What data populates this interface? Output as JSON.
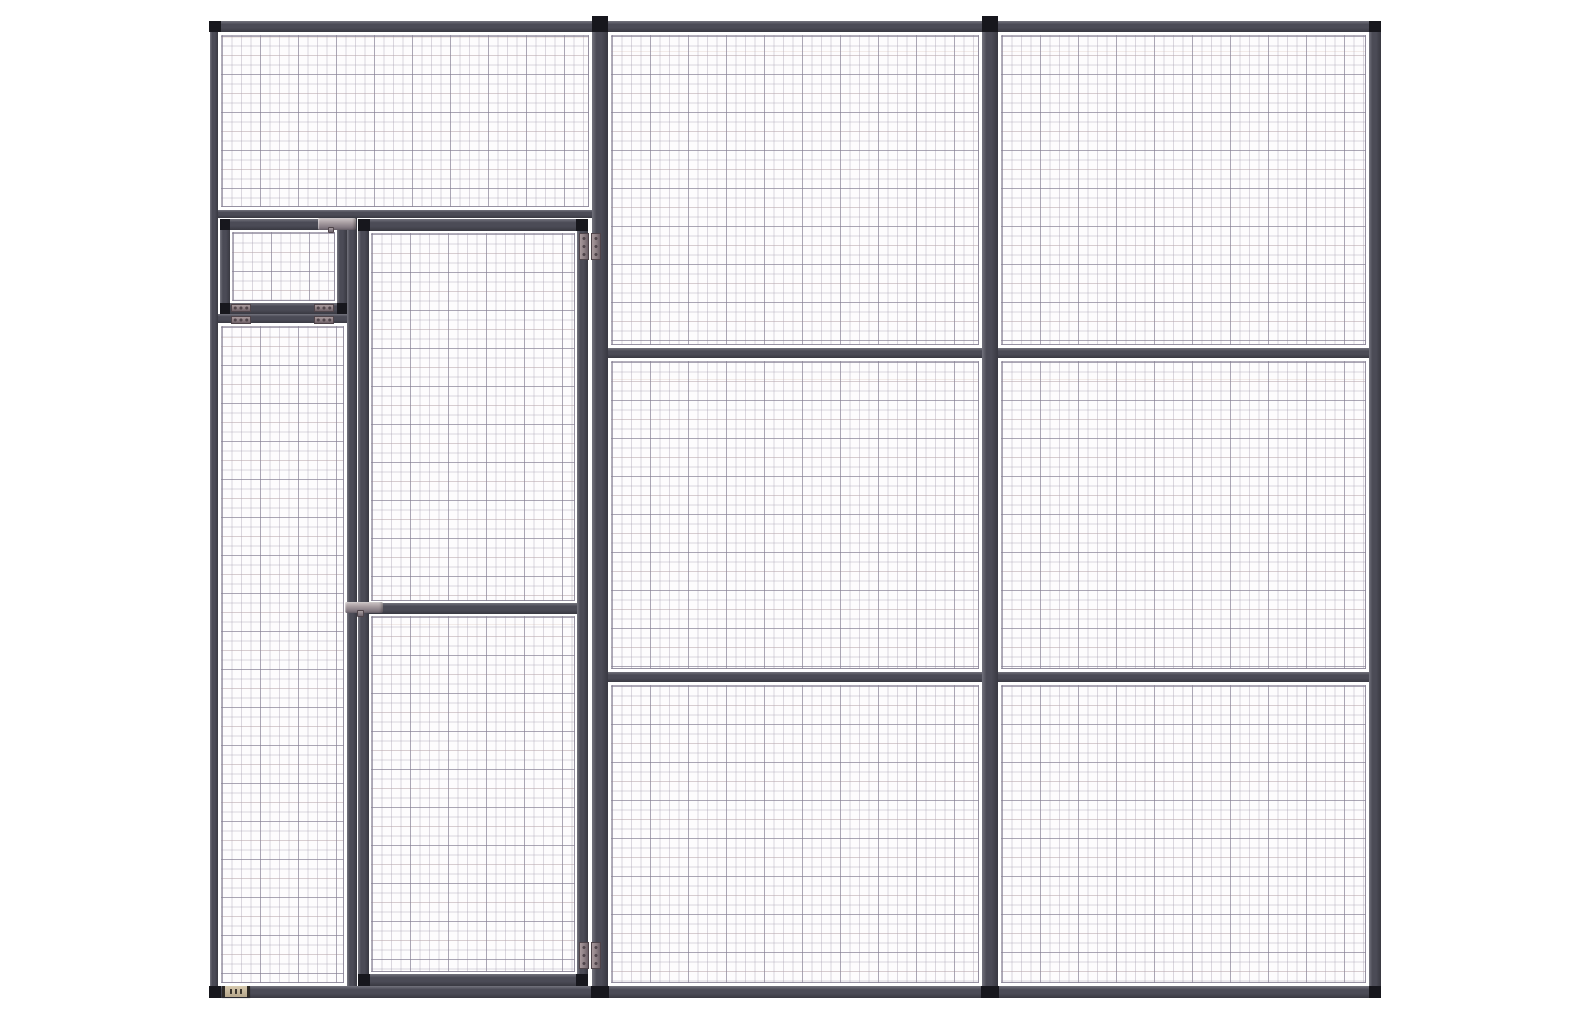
{
  "colors": {
    "background": "#ffffff",
    "panel_bg": "#fdfcfd",
    "frame": "#4b4b56",
    "frame_highlight": "#73737d",
    "frame_shadow": "#393942",
    "connector_block": "#17171d",
    "mesh_line": "rgba(168,162,178,0.42)",
    "mesh_line_major": "rgba(132,125,145,0.55)",
    "mesh_tint": "rgba(206,173,162,0.22)",
    "mesh_border": "rgba(140,133,152,0.65)",
    "hinge": "#8c7e83",
    "hinge_light": "#a99a9d",
    "hinge_dark2": "#6e6168",
    "hinge_dark": "#4f444a",
    "latch": "#a89da1",
    "latch_light": "#cfc7c9",
    "latch_dark": "#6f6670",
    "nameplate": "#b5a68a",
    "nameplate_light": "#d6c9ae",
    "nameplate_dark": "#3b352d",
    "nameplate_cap": "#2e2a26"
  },
  "parts": [
    {
      "kind": "mesh",
      "name": "left-bay-top-mesh-panel",
      "x": 221,
      "y": 35,
      "w": 368,
      "h": 172
    },
    {
      "kind": "mesh",
      "name": "left-column-mesh-panel",
      "x": 221,
      "y": 326,
      "w": 123,
      "h": 657
    },
    {
      "kind": "mesh",
      "name": "hatch-mesh-panel",
      "x": 232,
      "y": 232,
      "w": 103,
      "h": 69
    },
    {
      "kind": "mesh",
      "name": "door-upper-mesh-panel",
      "x": 371,
      "y": 233,
      "w": 204,
      "h": 368
    },
    {
      "kind": "mesh",
      "name": "door-lower-mesh-panel",
      "x": 371,
      "y": 616,
      "w": 204,
      "h": 356
    },
    {
      "kind": "mesh",
      "name": "mid-bay-top-mesh-panel",
      "x": 611,
      "y": 35,
      "w": 368,
      "h": 310
    },
    {
      "kind": "mesh",
      "name": "mid-bay-middle-mesh-panel",
      "x": 611,
      "y": 361,
      "w": 368,
      "h": 308
    },
    {
      "kind": "mesh",
      "name": "mid-bay-bottom-mesh-panel",
      "x": 611,
      "y": 685,
      "w": 368,
      "h": 298
    },
    {
      "kind": "mesh",
      "name": "right-bay-top-mesh-panel",
      "x": 1001,
      "y": 35,
      "w": 365,
      "h": 310
    },
    {
      "kind": "mesh",
      "name": "right-bay-middle-mesh-panel",
      "x": 1001,
      "y": 361,
      "w": 365,
      "h": 308
    },
    {
      "kind": "mesh",
      "name": "right-bay-bottom-mesh-panel",
      "x": 1001,
      "y": 685,
      "w": 365,
      "h": 298
    },
    {
      "kind": "rail",
      "name": "top-rail",
      "x": 210,
      "y": 21,
      "w": 1171,
      "h": 11
    },
    {
      "kind": "rail",
      "name": "bottom-rail",
      "x": 210,
      "y": 986,
      "w": 1171,
      "h": 12
    },
    {
      "kind": "rail",
      "name": "left-bay-transom-rail",
      "x": 218,
      "y": 210,
      "w": 374,
      "h": 8
    },
    {
      "kind": "rail",
      "name": "hatch-sill-rail",
      "x": 218,
      "y": 314,
      "w": 138,
      "h": 9
    },
    {
      "kind": "rail",
      "name": "mid-bay-upper-rail",
      "x": 608,
      "y": 348,
      "w": 374,
      "h": 10
    },
    {
      "kind": "rail",
      "name": "mid-bay-lower-rail",
      "x": 608,
      "y": 672,
      "w": 374,
      "h": 10
    },
    {
      "kind": "rail",
      "name": "right-bay-upper-rail",
      "x": 998,
      "y": 348,
      "w": 371,
      "h": 10
    },
    {
      "kind": "rail",
      "name": "right-bay-lower-rail",
      "x": 998,
      "y": 672,
      "w": 371,
      "h": 10
    },
    {
      "kind": "rail",
      "name": "hatch-top-rail",
      "x": 220,
      "y": 219,
      "w": 127,
      "h": 11
    },
    {
      "kind": "rail",
      "name": "hatch-bottom-rail",
      "x": 220,
      "y": 303,
      "w": 127,
      "h": 11
    },
    {
      "kind": "rail",
      "name": "door-top-rail",
      "x": 358,
      "y": 219,
      "w": 230,
      "h": 12
    },
    {
      "kind": "rail",
      "name": "door-mid-rail",
      "x": 358,
      "y": 603,
      "w": 230,
      "h": 11
    },
    {
      "kind": "rail",
      "name": "door-bottom-rail",
      "x": 358,
      "y": 974,
      "w": 230,
      "h": 12
    },
    {
      "kind": "post",
      "name": "left-upright-post",
      "x": 210,
      "y": 21,
      "w": 8,
      "h": 977
    },
    {
      "kind": "post",
      "name": "door-side-post",
      "x": 592,
      "y": 19,
      "w": 16,
      "h": 979
    },
    {
      "kind": "post",
      "name": "center-post",
      "x": 982,
      "y": 19,
      "w": 16,
      "h": 979
    },
    {
      "kind": "post",
      "name": "right-upright-post",
      "x": 1369,
      "y": 21,
      "w": 12,
      "h": 977
    },
    {
      "kind": "post",
      "name": "left-column-mullion",
      "x": 347,
      "y": 218,
      "w": 10,
      "h": 768
    },
    {
      "kind": "post",
      "name": "hatch-left-stile",
      "x": 220,
      "y": 219,
      "w": 10,
      "h": 95
    },
    {
      "kind": "post",
      "name": "hatch-right-stile",
      "x": 337,
      "y": 219,
      "w": 10,
      "h": 95
    },
    {
      "kind": "post",
      "name": "door-left-stile",
      "x": 358,
      "y": 219,
      "w": 11,
      "h": 767
    },
    {
      "kind": "post",
      "name": "door-right-stile",
      "x": 577,
      "y": 219,
      "w": 11,
      "h": 767
    },
    {
      "kind": "block",
      "name": "top-left-corner-block",
      "x": 209,
      "y": 21,
      "w": 12,
      "h": 11
    },
    {
      "kind": "block",
      "name": "top-right-corner-block",
      "x": 1369,
      "y": 21,
      "w": 12,
      "h": 11
    },
    {
      "kind": "block",
      "name": "door-post-top-cap",
      "x": 592,
      "y": 16,
      "w": 16,
      "h": 16
    },
    {
      "kind": "block",
      "name": "center-post-top-cap",
      "x": 982,
      "y": 16,
      "w": 16,
      "h": 16
    },
    {
      "kind": "block",
      "name": "bottom-left-corner-block",
      "x": 209,
      "y": 986,
      "w": 12,
      "h": 12
    },
    {
      "kind": "block",
      "name": "door-post-foot-block",
      "x": 591,
      "y": 986,
      "w": 18,
      "h": 12
    },
    {
      "kind": "block",
      "name": "center-post-foot-block",
      "x": 981,
      "y": 986,
      "w": 18,
      "h": 12
    },
    {
      "kind": "block",
      "name": "bottom-right-corner-block",
      "x": 1369,
      "y": 986,
      "w": 12,
      "h": 12
    },
    {
      "kind": "block",
      "name": "hatch-top-left-corner-block",
      "x": 220,
      "y": 219,
      "w": 10,
      "h": 11
    },
    {
      "kind": "block",
      "name": "hatch-top-right-corner-block",
      "x": 337,
      "y": 219,
      "w": 10,
      "h": 11
    },
    {
      "kind": "block",
      "name": "hatch-bottom-left-corner-block",
      "x": 220,
      "y": 303,
      "w": 10,
      "h": 11
    },
    {
      "kind": "block",
      "name": "hatch-bottom-right-corner-block",
      "x": 337,
      "y": 303,
      "w": 10,
      "h": 11
    },
    {
      "kind": "block",
      "name": "door-top-left-corner-block",
      "x": 358,
      "y": 219,
      "w": 12,
      "h": 12
    },
    {
      "kind": "block",
      "name": "door-top-right-corner-block",
      "x": 576,
      "y": 219,
      "w": 12,
      "h": 12
    },
    {
      "kind": "block",
      "name": "door-bottom-left-corner-block",
      "x": 358,
      "y": 974,
      "w": 12,
      "h": 12
    },
    {
      "kind": "block",
      "name": "door-bottom-right-corner-block",
      "x": 576,
      "y": 974,
      "w": 12,
      "h": 12
    },
    {
      "kind": "hinge-v",
      "name": "door-top-hinge",
      "x": 579,
      "y": 233,
      "w": 22,
      "h": 27
    },
    {
      "kind": "hinge-v",
      "name": "door-bottom-hinge",
      "x": 579,
      "y": 942,
      "w": 22,
      "h": 27
    },
    {
      "kind": "hinge-h",
      "name": "hatch-left-hinge",
      "x": 231,
      "y": 304,
      "w": 20,
      "h": 20
    },
    {
      "kind": "hinge-h",
      "name": "hatch-right-hinge",
      "x": 314,
      "y": 304,
      "w": 20,
      "h": 20
    },
    {
      "kind": "latch",
      "name": "hatch-latch-bolt",
      "x": 318,
      "y": 218,
      "w": 38,
      "h": 12
    },
    {
      "kind": "knob",
      "name": "hatch-latch-knob",
      "x": 328,
      "y": 227,
      "w": 6,
      "h": 6
    },
    {
      "kind": "latch",
      "name": "door-latch-bolt",
      "x": 345,
      "y": 602,
      "w": 38,
      "h": 11
    },
    {
      "kind": "knob",
      "name": "door-latch-knob",
      "x": 357,
      "y": 610,
      "w": 7,
      "h": 7
    },
    {
      "kind": "plate",
      "name": "manufacturer-nameplate",
      "x": 222,
      "y": 986,
      "w": 28,
      "h": 11
    }
  ]
}
